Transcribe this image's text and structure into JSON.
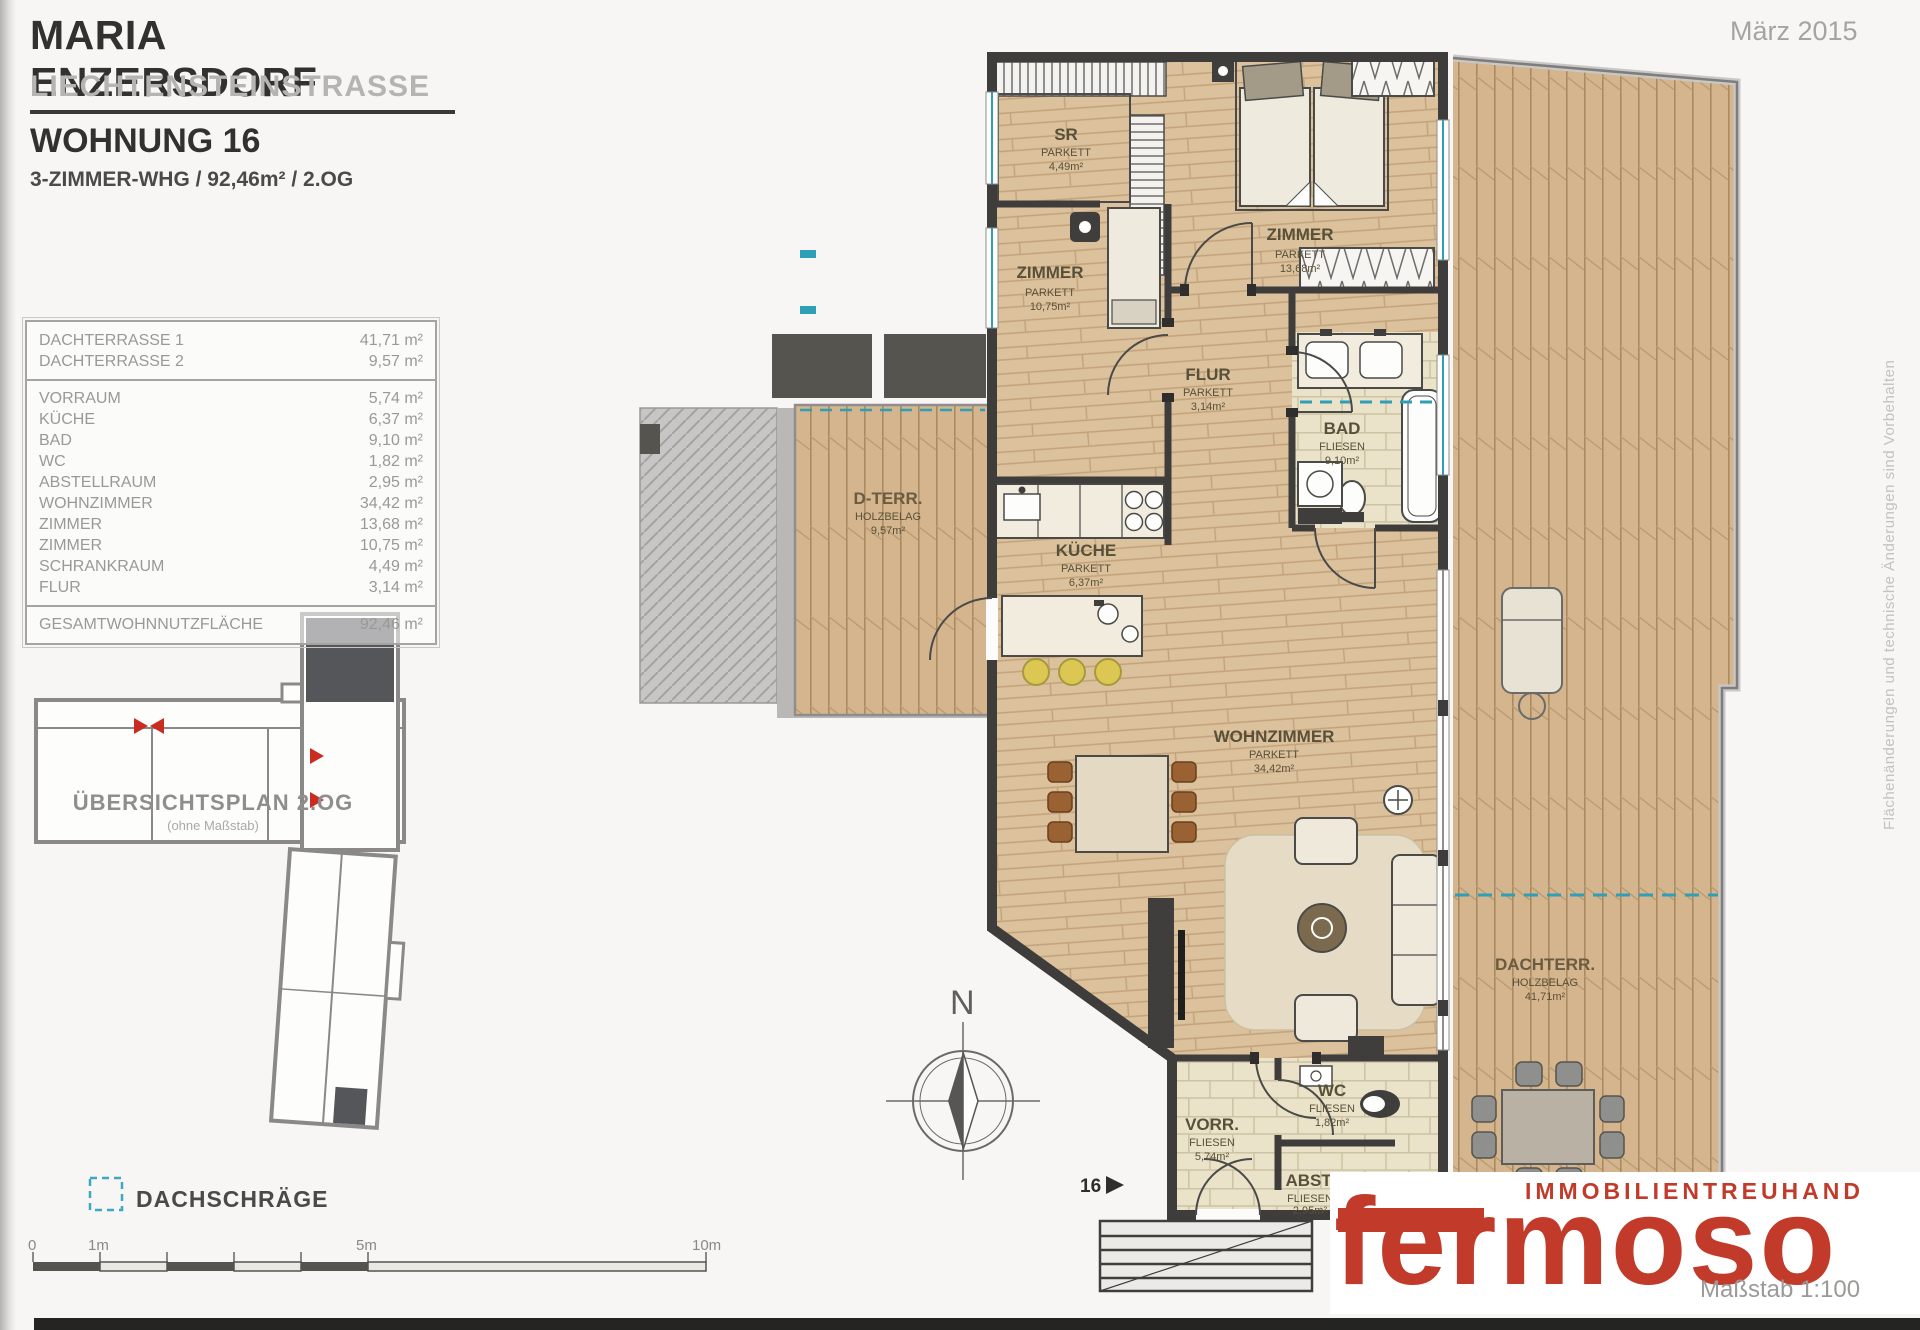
{
  "header": {
    "project_title": "MARIA ENZERSDORF",
    "project_subtitle": "LIECHTENSTEINSTRASSE",
    "unit_title": "WOHNUNG 16",
    "unit_specs": "3-ZIMMER-WHG / 92,46m² / 2.OG",
    "date": "März 2015"
  },
  "area_table": {
    "terrace_rows": [
      {
        "label": "DACHTERRASSE 1",
        "value": "41,71 m²"
      },
      {
        "label": "DACHTERRASSE 2",
        "value": "9,57 m²"
      }
    ],
    "room_rows": [
      {
        "label": "VORRAUM",
        "value": "5,74 m²"
      },
      {
        "label": "KÜCHE",
        "value": "6,37 m²"
      },
      {
        "label": "BAD",
        "value": "9,10 m²"
      },
      {
        "label": "WC",
        "value": "1,82 m²"
      },
      {
        "label": "ABSTELLRAUM",
        "value": "2,95 m²"
      },
      {
        "label": "WOHNZIMMER",
        "value": "34,42 m²"
      },
      {
        "label": "ZIMMER",
        "value": "13,68 m²"
      },
      {
        "label": "ZIMMER",
        "value": "10,75 m²"
      },
      {
        "label": "SCHRANKRAUM",
        "value": "4,49 m²"
      },
      {
        "label": "FLUR",
        "value": "3,14 m²"
      }
    ],
    "total_row": {
      "label": "GESAMTWOHNNUTZFLÄCHE",
      "value": "92,46 m²"
    }
  },
  "overview": {
    "title": "ÜBERSICHTSPLAN 2.OG",
    "subtitle": "(ohne Maßstab)"
  },
  "legend": {
    "label": "DACHSCHRÄGE"
  },
  "scalebar": {
    "labels": [
      "0",
      "1m",
      "5m",
      "10m"
    ]
  },
  "plan": {
    "compass_label": "N",
    "unit_marker": "16",
    "rooms": [
      {
        "name": "SR",
        "type": "PARKETT",
        "area": "4,49m²"
      },
      {
        "name": "ZIMMER",
        "type": "PARKETT",
        "area": "13,68m²"
      },
      {
        "name": "ZIMMER",
        "type": "PARKETT",
        "area": "10,75m²"
      },
      {
        "name": "FLUR",
        "type": "PARKETT",
        "area": "3,14m²"
      },
      {
        "name": "BAD",
        "type": "FLIESEN",
        "area": "9,10m²"
      },
      {
        "name": "KÜCHE",
        "type": "PARKETT",
        "area": "6,37m²"
      },
      {
        "name": "WOHNZIMMER",
        "type": "PARKETT",
        "area": "34,42m²"
      },
      {
        "name": "D-TERR.",
        "type": "HOLZBELAG",
        "area": "9,57m²"
      },
      {
        "name": "DACHTERR.",
        "type": "HOLZBELAG",
        "area": "41,71m²"
      },
      {
        "name": "VORR.",
        "type": "FLIESEN",
        "area": "5,74m²"
      },
      {
        "name": "WC",
        "type": "FLIESEN",
        "area": "1,82m²"
      },
      {
        "name": "ABST.",
        "type": "FLIESEN",
        "area": "2,95m²"
      }
    ]
  },
  "branding": {
    "tagline": "IMMOBILIENTREUHAND",
    "name": "fermoso",
    "scale_note": "Maßstab 1:100"
  },
  "notes": {
    "disclaimer": "Flächenänderungen und technische Änderungen sind Vorbehalten"
  },
  "colors": {
    "brand_red": "#c23b2a",
    "accent_teal": "#2f9fb7",
    "wall": "#3e3d3b",
    "parquet": "#dcc19d",
    "deck": "#d4b58d",
    "tile": "#eae3c9"
  }
}
